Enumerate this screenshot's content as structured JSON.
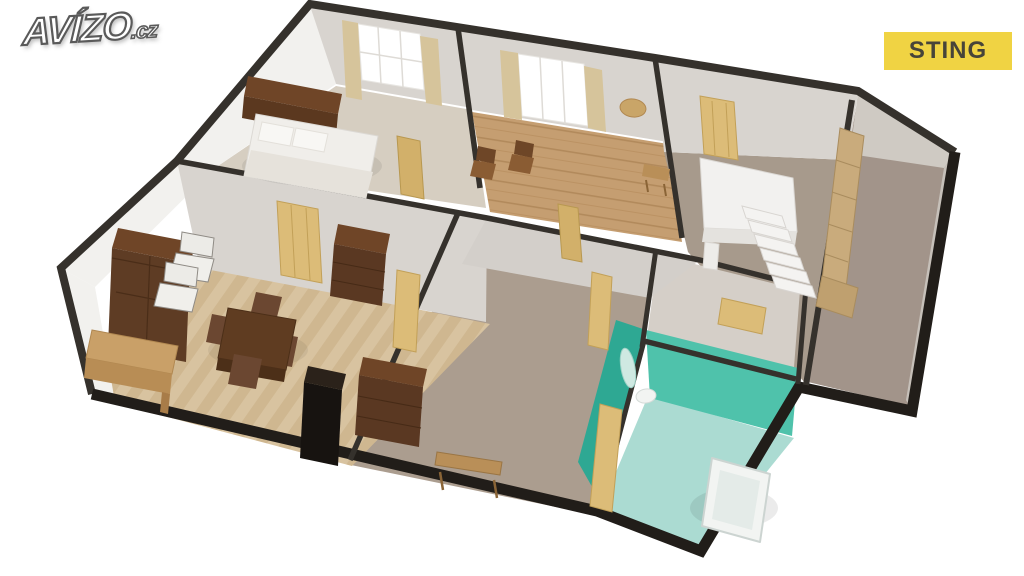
{
  "branding": {
    "logo_text": "AVÍZO",
    "logo_suffix": ".cz",
    "badge_label": "STING"
  },
  "palette": {
    "badge-bg": "#f0d343",
    "badge-text": "#474439",
    "logo-fill": "#ffffff",
    "logo-outline": "#5a5a5a",
    "wall-dark": "#35312c",
    "wall-face": "#d8d4cf",
    "wall-white": "#f2f1ee",
    "carpet": "#a79a8c",
    "carpet-dark": "#a2948a",
    "parquet-light": "#d8c3a0",
    "parquet-dark": "#cfb790",
    "plank": "#c59e71",
    "bedroom-floor": "#d6cec1",
    "bath-wall": "#4fc2ab",
    "bath-wall-dark": "#2ea893",
    "bath-floor": "#abdbd2",
    "wood-dark": "#5e3c24",
    "wood-mid": "#6f4527",
    "wood-light": "#c9a568",
    "door-tan": "#dcbc78",
    "white-fixture": "#f2f4f2"
  },
  "scene": {
    "type": "3d-floorplan-render",
    "rooms": [
      {
        "name": "bedroom",
        "features": [
          "double-bed",
          "headboard-cabinet",
          "window",
          "curtains",
          "picture-frame"
        ]
      },
      {
        "name": "second-room",
        "features": [
          "window",
          "curtains",
          "two-chairs",
          "wood-plank-floor"
        ]
      },
      {
        "name": "hallway",
        "features": [
          "entry-door",
          "console-table",
          "bench",
          "staircase"
        ]
      },
      {
        "name": "living-room",
        "features": [
          "display-cabinet",
          "two-armchairs",
          "writing-desk",
          "dining-table",
          "four-chairs",
          "chest-of-drawers",
          "stove",
          "herringbone-parquet"
        ]
      },
      {
        "name": "middle-room",
        "features": [
          "chest-of-drawers",
          "bench",
          "doors"
        ]
      },
      {
        "name": "bathroom",
        "features": [
          "bathtub",
          "washbasin",
          "mirror",
          "teal-walls"
        ]
      },
      {
        "name": "right-room",
        "features": [
          "wardrobes",
          "carpet-floor"
        ]
      }
    ]
  }
}
